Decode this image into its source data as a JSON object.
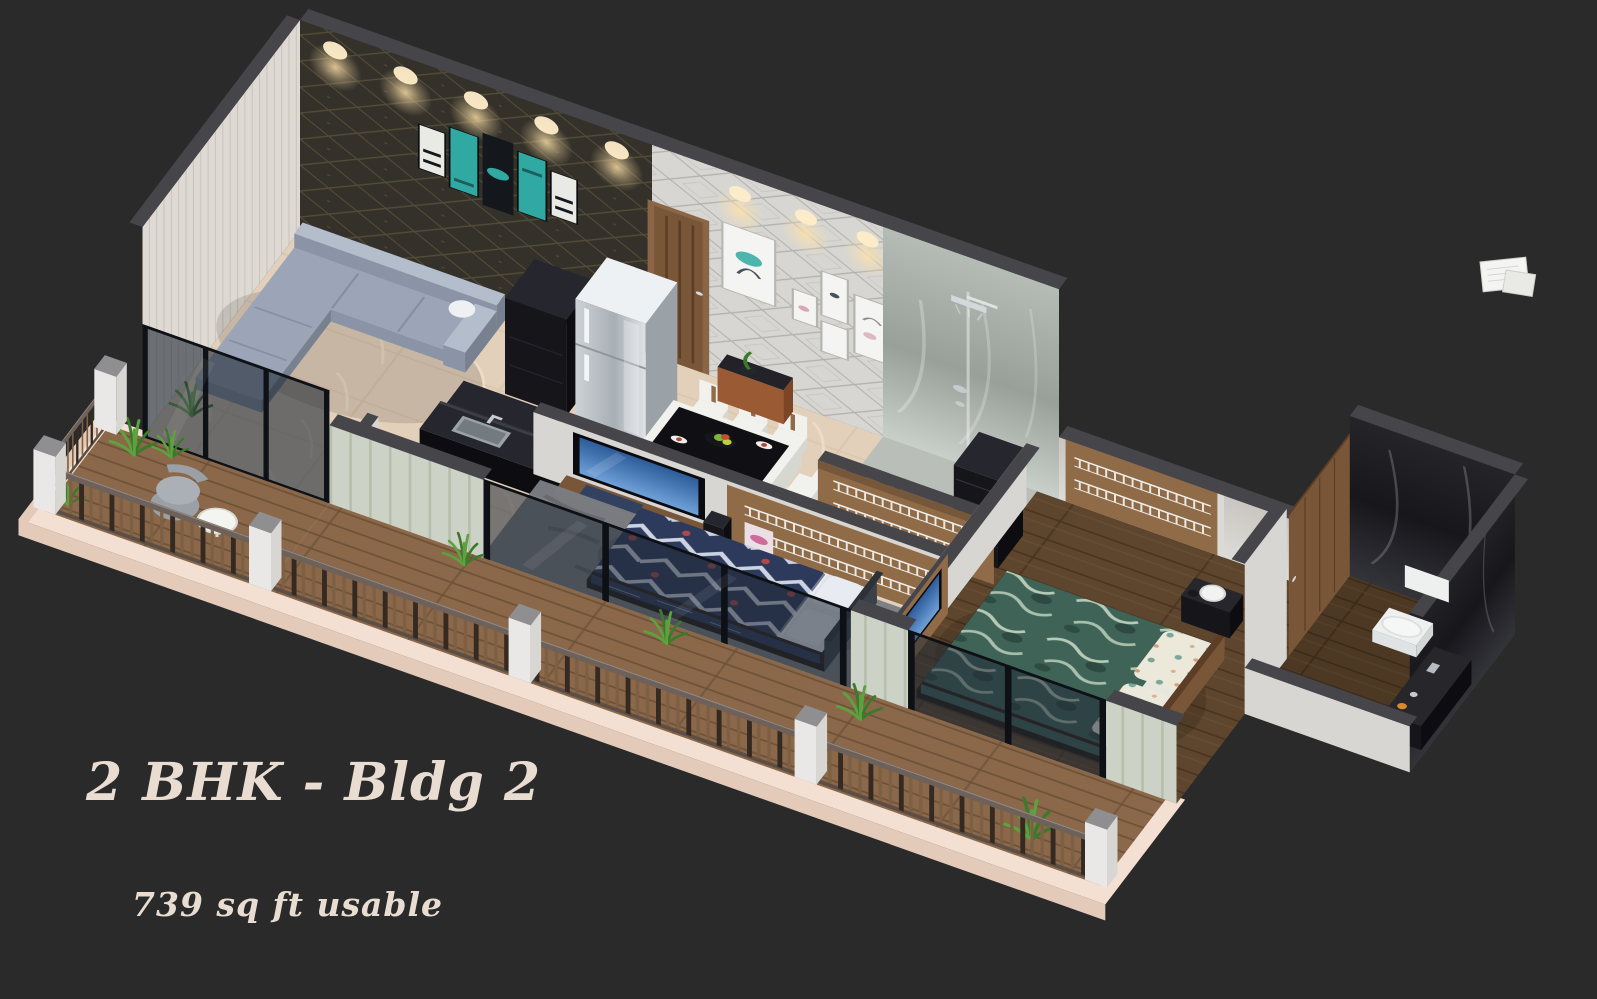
{
  "title": {
    "text": "2 BHK - Bldg 2"
  },
  "subtitle": {
    "text": "739 sq ft usable"
  },
  "meta": {
    "plan_type": "2 BHK",
    "building": "Bldg 2",
    "usable_area_sqft": 739
  },
  "scene": {
    "style": "isometric-3d-apartment-render",
    "rooms": [
      "living-room",
      "kitchen",
      "dining-area",
      "bathroom",
      "wardrobe-1",
      "bedroom-1",
      "bedroom-2",
      "wardrobe-2",
      "toilet",
      "balcony-left",
      "balcony-front"
    ],
    "furniture": [
      "sectional-sofa",
      "tv-unit",
      "kitchen-island",
      "tall-cabinet",
      "refrigerator",
      "washing-machine",
      "dining-table",
      "dining-chairs",
      "console-table",
      "wall-art",
      "bed-1",
      "bed-2",
      "wall-tv-1",
      "wall-tv-2",
      "shower",
      "wash-basin",
      "toilet-seat",
      "wardrobe-racks",
      "balcony-railing",
      "potted-plants",
      "outdoor-chair",
      "outdoor-table"
    ]
  },
  "palette": {
    "bg": "#2a2a2b",
    "caption": "#e9ddd2",
    "ledge": "#f3e0d2",
    "ledge_face": "#e4cab9",
    "floor_marble": "#e3d0ba",
    "floor_marble_line": "#d2bca0",
    "gray_tile": "#b9beb8",
    "wood_floor": "#5e452d",
    "wood_floor_line": "#49351f",
    "deck": "#8a6849",
    "deck_line": "#6d5138",
    "wall_top": "#46464a",
    "wall_white": "#d8d6d2",
    "wall_white_lo": "#c7c4bf",
    "wall_texture": "#dedad3",
    "hatch_line": "#cac4bb",
    "front_wall": "#ccd2c6",
    "front_wall_line": "#b7bfac",
    "accent": "#34312a",
    "accent_line": "#6e6444",
    "wallpaper": "#d7d6d2",
    "wallpaper_line": "#a9a9a3",
    "marble_hi": "#c9cfc9",
    "marble_mid": "#99a09a",
    "marble_lo": "#b5bbb5",
    "bmarble_hi": "#33333a",
    "bmarble_mid": "#17171b",
    "bmarble_lo": "#242429",
    "railing_top": "#6e6159",
    "railing_bottom": "#5c4e45",
    "baluster": "#7d5f43",
    "baluster_dark": "#352a22",
    "sofa": "#9ba5b7",
    "sofa_light": "#b4bdcc",
    "sofa_mid": "#8a94a6",
    "sofa_dark": "#77818f",
    "black": "#15151a",
    "black_hi": "#26262e",
    "black_lo": "#0d0d11",
    "steel_top": "#eef1f3",
    "steel_side": "#9aa1a7",
    "steel_line": "#8e969c",
    "steel_a": "#cdd2d6",
    "steel_b": "#a8afb5",
    "steel_c": "#dfe3e6",
    "wood": "#7a5638",
    "wood_dark": "#5c3e26",
    "wood_light": "#906b47",
    "bed_base": "#2a2119",
    "bed1": "#2d3a5c",
    "bed1_line": "#ccd3e3",
    "bed1_red": "#b04a4a",
    "pillow": "#e8ebf1",
    "headboard1": "#3b4049",
    "bed2": "#3f6357",
    "bed2_line": "#bccfbd",
    "bed2_dark": "#2b463e",
    "sheet": "#e7e6df",
    "floral": "#ece9db",
    "floral_dot": "#7aa79b",
    "floral_dot2": "#cfa37a",
    "rug": "#7b7d82",
    "rug_line": "#5d5f64",
    "plant": "#5da23f",
    "plant_dark": "#3c7a2b",
    "tv_frame": "#0b0b0f",
    "tv_hi": "#6fa0d8",
    "tv_lo": "#2d5c9a",
    "glow": "#ffe2a8",
    "glow_core": "#ffedc9",
    "glass": "#202a36",
    "chair": "#9aa0a6",
    "chair_hi": "#aab0b6",
    "white": "#f1f1ee",
    "white_mid": "#e4e4e0",
    "white_lo": "#d7d7d2",
    "teal": "#2fa9a2",
    "toilet_white": "#eef0f0",
    "toilet_mid": "#e0e3e3",
    "toilet_lo": "#d2d6d6",
    "orange": "#d9892b",
    "pink": "#d06a9a",
    "poster": "#eadfe4",
    "pad_blue": "#31415f",
    "paper": "#f4f4f2",
    "paper2": "#e9e9e6",
    "paper_line": "#cfcfca",
    "silver": "#c6cbd1",
    "dark_top": "#222228",
    "leg_orange": "#9a5a33",
    "leg_orange2": "#7c4526",
    "pier_top": "#8f8f92",
    "pier_front": "#e9e8e6",
    "pier_side": "#d7d6d3"
  }
}
